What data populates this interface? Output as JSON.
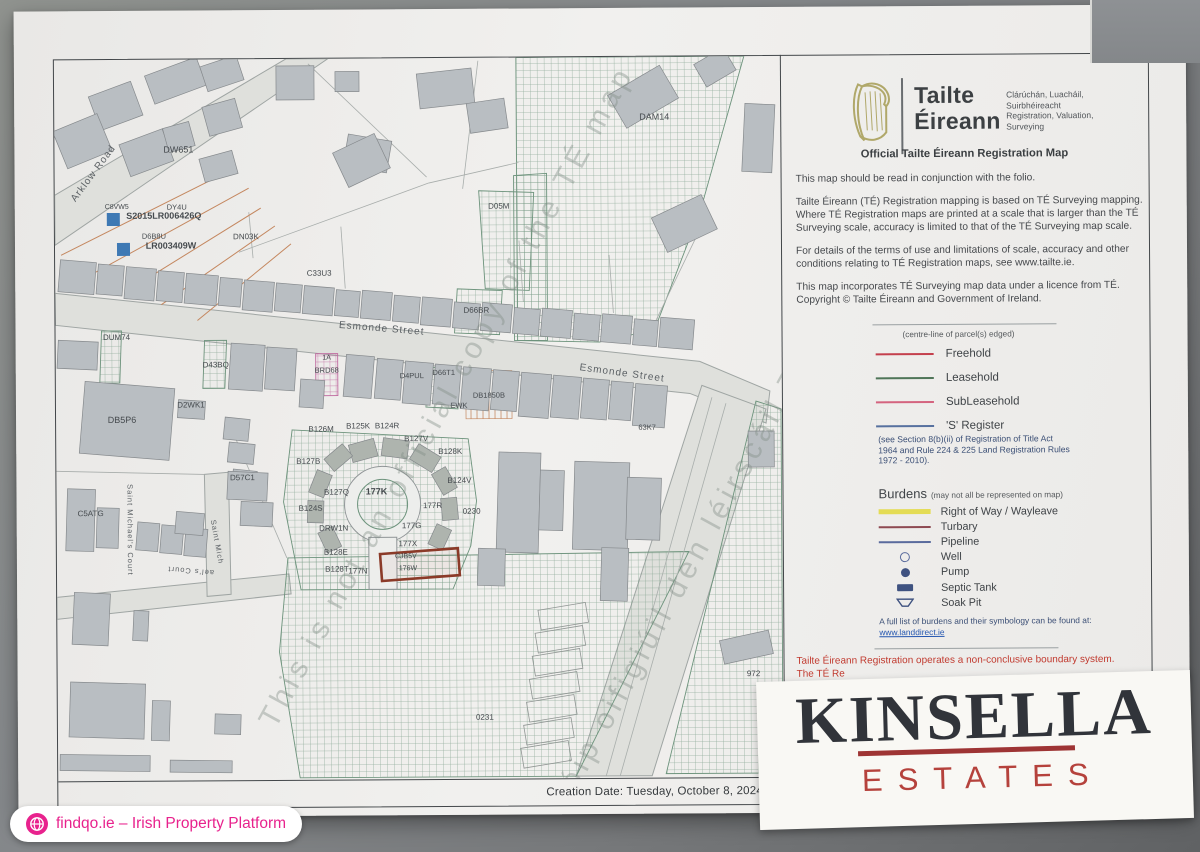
{
  "colors": {
    "accent_pink": "#e8228d",
    "kinsella_dark": "#31343a",
    "kinsella_red": "#b5423c",
    "notice_red": "#c13a2f",
    "paper": "#f1f0ee",
    "frame": "#43474a",
    "building": "#b9bec2",
    "hatch_green": "#6d937c",
    "hatch_pink": "#c06aa0",
    "blue_marker": "#3e79b4",
    "red_parcel": "#8b3a28"
  },
  "brand": {
    "name1": "Tailte",
    "name2": "Éireann",
    "sub": [
      "Clárúchán, Luacháil,",
      "Suirbhéireacht",
      "Registration, Valuation,",
      "Surveying"
    ]
  },
  "panel": {
    "heading": "Official Tailte Éireann Registration Map",
    "paragraphs": [
      "This map should be read in conjunction with the folio.",
      "Tailte Éireann (TÉ) Registration mapping is based on TÉ Surveying mapping. Where TÉ Registration maps are printed at a scale that is larger than the TÉ Surveying scale, accuracy is limited to that of the TÉ Surveying map scale.",
      "For details of the terms of use and limitations of scale, accuracy and other conditions relating to TÉ Registration maps, see www.tailte.ie.",
      "This map incorporates TÉ Surveying map data under a licence from TÉ. Copyright © Tailte Éireann and Government of Ireland."
    ],
    "legend_note_top": "(centre-line of parcel(s) edged)",
    "legend_items": [
      {
        "label": "Freehold",
        "type": "line",
        "color": "#c4404d"
      },
      {
        "label": "Leasehold",
        "type": "line",
        "color": "#4f7558"
      },
      {
        "label": "SubLeasehold",
        "type": "line",
        "color": "#d4647f"
      },
      {
        "label": "'S' Register",
        "type": "line",
        "color": "#57719f"
      }
    ],
    "legend_note_bottom": "(see Section 8(b)(ii) of Registration of Title Act 1964 and Rule 224 & 225 Land Registration Rules 1972 - 2010).",
    "burdens_title": "Burdens",
    "burdens_note": "(may not all be represented on map)",
    "burden_items": [
      {
        "label": "Right of Way / Wayleave",
        "type": "bar",
        "color": "#e4dc55"
      },
      {
        "label": "Turbary",
        "type": "line",
        "color": "#8e4a52"
      },
      {
        "label": "Pipeline",
        "type": "line",
        "color": "#5a6b9d"
      },
      {
        "label": "Well",
        "type": "circle-outline",
        "color": "#5a6b9d"
      },
      {
        "label": "Pump",
        "type": "circle-fill",
        "color": "#3f5280"
      },
      {
        "label": "Septic Tank",
        "type": "rect-fill",
        "color": "#3f5280"
      },
      {
        "label": "Soak Pit",
        "type": "trapezoid",
        "color": "#3f5280"
      }
    ],
    "burdens_footer": "A full list of burdens and their symbology can be found at: ",
    "burdens_link": "www.landdirect.ie",
    "boundary_notice": "Tailte Éireann Registration operates a non-conclusive boundary system.",
    "boundary_notice2": "The TÉ Re"
  },
  "creation_date": "Creation Date: Tuesday, October 8, 2024 3:4",
  "kinsella": {
    "line1": "KINSELLA",
    "line2": "ESTATES"
  },
  "badge": {
    "text": "findqo.ie – Irish Property Platform"
  },
  "map": {
    "roads": [
      "56,290 700,362 770,392 766,424 690,394 56,322",
      "702,386 766,410 650,776 574,776",
      "56,192 288,57 330,57 56,242",
      "56,594 288,572 290,592 56,616",
      "204,472 228,470 230,592 206,594"
    ],
    "hatches": [
      {
        "pts": "518,57 746,57 702,210 655,330 600,342 518,340 518,250",
        "p": "gh"
      },
      {
        "pts": "515,175 548,173 548,340 515,340",
        "p": "gh"
      },
      {
        "pts": "480,190 535,192 530,290 486,288",
        "p": "gh"
      },
      {
        "pts": "458,288 503,290 500,334 455,332",
        "p": "gh"
      },
      {
        "pts": "102,328 122,328 120,380 100,380",
        "p": "gh"
      },
      {
        "pts": "205,338 227,338 225,386 203,386",
        "p": "gh"
      },
      {
        "pts": "428,366 460,368 458,408 426,406",
        "p": "gh"
      },
      {
        "pts": "292,428 468,438 476,500 470,545 452,588 300,588 283,500",
        "p": "gh"
      },
      {
        "pts": "287,556 688,552 574,776 298,776 278,650",
        "p": "gh"
      },
      {
        "pts": "756,402 781,410 781,774 664,774",
        "p": "gh"
      },
      {
        "pts": "316,352 338,352 338,394 316,394",
        "p": "ph"
      }
    ],
    "tanrect": [
      466,
      370,
      46,
      48
    ],
    "gray_lines": [
      [
        240,
        250,
        430,
        182
      ],
      [
        430,
        182,
        520,
        162
      ],
      [
        310,
        62,
        428,
        176
      ],
      [
        480,
        60,
        464,
        188
      ],
      [
        700,
        232,
        652,
        330
      ],
      [
        232,
        428,
        286,
        556
      ],
      [
        56,
        468,
        204,
        472
      ],
      [
        712,
        398,
        604,
        776
      ],
      [
        726,
        404,
        618,
        776
      ],
      [
        250,
        210,
        254,
        256
      ],
      [
        342,
        225,
        346,
        287
      ],
      [
        520,
        240,
        524,
        301
      ],
      [
        610,
        255,
        614,
        313
      ]
    ],
    "tan_lines": [
      [
        62,
        252,
        232,
        168
      ],
      [
        95,
        270,
        250,
        186
      ],
      [
        128,
        288,
        262,
        206
      ],
      [
        162,
        302,
        276,
        224
      ],
      [
        198,
        318,
        292,
        242
      ]
    ],
    "ladder": [
      [
        538,
        606
      ],
      [
        535,
        629
      ],
      [
        532,
        652
      ],
      [
        529,
        675
      ],
      [
        526,
        698
      ],
      [
        523,
        721
      ],
      [
        520,
        744
      ]
    ],
    "buildings": [
      [
        60,
        258,
        36,
        32,
        5
      ],
      [
        98,
        262,
        26,
        30,
        5
      ],
      [
        126,
        265,
        30,
        32,
        5
      ],
      [
        158,
        269,
        26,
        30,
        5
      ],
      [
        186,
        272,
        32,
        30,
        5
      ],
      [
        220,
        276,
        22,
        28,
        5
      ],
      [
        244,
        279,
        30,
        30,
        5
      ],
      [
        276,
        282,
        26,
        28,
        5
      ],
      [
        304,
        285,
        30,
        28,
        5
      ],
      [
        336,
        289,
        24,
        26,
        5
      ],
      [
        362,
        290,
        30,
        28,
        5
      ],
      [
        394,
        295,
        26,
        26,
        5
      ],
      [
        422,
        297,
        30,
        28,
        5
      ],
      [
        454,
        302,
        26,
        26,
        5
      ],
      [
        482,
        303,
        30,
        28,
        5
      ],
      [
        514,
        308,
        26,
        26,
        5
      ],
      [
        542,
        309,
        30,
        28,
        5
      ],
      [
        574,
        314,
        26,
        26,
        5
      ],
      [
        602,
        315,
        30,
        28,
        5
      ],
      [
        634,
        320,
        24,
        26,
        5
      ],
      [
        660,
        319,
        34,
        30,
        5
      ],
      [
        230,
        342,
        34,
        46,
        4
      ],
      [
        266,
        346,
        30,
        42,
        4
      ],
      [
        300,
        378,
        24,
        28,
        4
      ],
      [
        345,
        354,
        28,
        42,
        5
      ],
      [
        376,
        358,
        26,
        40,
        5
      ],
      [
        404,
        361,
        28,
        42,
        5
      ],
      [
        434,
        364,
        26,
        40,
        5
      ],
      [
        462,
        367,
        28,
        42,
        5
      ],
      [
        492,
        370,
        26,
        40,
        5
      ],
      [
        520,
        373,
        30,
        44,
        5
      ],
      [
        552,
        376,
        28,
        42,
        5
      ],
      [
        582,
        379,
        26,
        40,
        5
      ],
      [
        610,
        382,
        22,
        38,
        5
      ],
      [
        634,
        385,
        32,
        42,
        5
      ],
      [
        150,
        63,
        55,
        30,
        -20
      ],
      [
        95,
        85,
        45,
        36,
        -20
      ],
      [
        205,
        58,
        38,
        26,
        -18
      ],
      [
        60,
        118,
        48,
        40,
        -22
      ],
      [
        125,
        133,
        46,
        34,
        -20
      ],
      [
        278,
        64,
        38,
        34,
        0
      ],
      [
        337,
        70,
        24,
        20,
        0
      ],
      [
        207,
        100,
        34,
        30,
        -15
      ],
      [
        167,
        122,
        27,
        25,
        -15
      ],
      [
        347,
        136,
        44,
        32,
        10
      ],
      [
        203,
        152,
        34,
        24,
        -15
      ],
      [
        420,
        70,
        55,
        35,
        -6
      ],
      [
        340,
        140,
        46,
        38,
        -25
      ],
      [
        470,
        100,
        38,
        30,
        -8
      ],
      [
        615,
        78,
        60,
        38,
        -30
      ],
      [
        700,
        55,
        34,
        26,
        -30
      ],
      [
        745,
        105,
        30,
        68,
        3
      ],
      [
        658,
        205,
        55,
        38,
        -25
      ],
      [
        82,
        382,
        90,
        72,
        5
      ],
      [
        178,
        398,
        27,
        18,
        4
      ],
      [
        58,
        338,
        40,
        28,
        3
      ],
      [
        224,
        416,
        25,
        22,
        6
      ],
      [
        228,
        441,
        26,
        20,
        6
      ],
      [
        232,
        468,
        24,
        18,
        6
      ],
      [
        227,
        470,
        40,
        28,
        3
      ],
      [
        240,
        500,
        32,
        24,
        3
      ],
      [
        66,
        486,
        28,
        62,
        2
      ],
      [
        96,
        505,
        22,
        40,
        2
      ],
      [
        136,
        520,
        22,
        28,
        5
      ],
      [
        160,
        523,
        22,
        28,
        5
      ],
      [
        184,
        526,
        22,
        28,
        5
      ],
      [
        175,
        510,
        28,
        22,
        5
      ],
      [
        72,
        590,
        36,
        52,
        3
      ],
      [
        132,
        608,
        15,
        30,
        3
      ],
      [
        68,
        680,
        75,
        55,
        2
      ],
      [
        150,
        698,
        18,
        40,
        2
      ],
      [
        213,
        712,
        26,
        20,
        2
      ],
      [
        58,
        752,
        90,
        16,
        1
      ],
      [
        168,
        758,
        62,
        12,
        1
      ],
      [
        497,
        452,
        42,
        100,
        2
      ],
      [
        539,
        470,
        24,
        60,
        2
      ],
      [
        573,
        462,
        55,
        88,
        2
      ],
      [
        626,
        478,
        34,
        62,
        2
      ],
      [
        477,
        548,
        27,
        37,
        2
      ],
      [
        600,
        548,
        27,
        53,
        2
      ],
      [
        720,
        636,
        50,
        24,
        -12
      ],
      [
        748,
        432,
        26,
        36,
        0
      ]
    ],
    "petals": [
      [
        350,
        440,
        26,
        18,
        -15
      ],
      [
        382,
        438,
        26,
        18,
        8
      ],
      [
        412,
        448,
        26,
        18,
        32
      ],
      [
        432,
        472,
        24,
        16,
        60
      ],
      [
        438,
        500,
        22,
        16,
        85
      ],
      [
        326,
        448,
        24,
        16,
        -40
      ],
      [
        308,
        474,
        24,
        16,
        -68
      ],
      [
        304,
        502,
        22,
        16,
        -88
      ],
      [
        318,
        530,
        22,
        16,
        -115
      ],
      [
        428,
        528,
        22,
        16,
        115
      ]
    ],
    "keyhole": {
      "cx": 382,
      "cy": 503,
      "r_outer": 38,
      "r_inner": 25,
      "stem": [
        368,
        536,
        28,
        52
      ]
    },
    "red_parcel": {
      "x": 380,
      "y": 550,
      "w": 78,
      "h": 27,
      "rot": -4
    },
    "blue_squares": [
      [
        108,
        210,
        13
      ],
      [
        118,
        240,
        13
      ]
    ],
    "street_labels": [
      [
        "Arklow Road",
        97,
        172,
        -53,
        10
      ],
      [
        "Esmonde Street",
        382,
        330,
        5,
        10
      ],
      [
        "Esmonde Street",
        622,
        376,
        8,
        10
      ],
      [
        "Saint Michael's Court",
        127,
        527,
        90,
        7.5
      ],
      [
        "Saint Mich",
        214,
        540,
        80,
        7.5
      ],
      [
        "ael's Court",
        190,
        566,
        185,
        7.5
      ]
    ],
    "parcel_labels": [
      [
        "DW651",
        180,
        150,
        9,
        0,
        400
      ],
      [
        "DAM14",
        656,
        120,
        9,
        0,
        400
      ],
      [
        "D05M",
        500,
        208,
        8,
        0,
        400
      ],
      [
        "DN03K",
        247,
        237,
        8,
        0,
        400
      ],
      [
        "C33U3",
        320,
        274,
        8,
        0,
        400
      ],
      [
        "C8VW5",
        118,
        206,
        7,
        0,
        400
      ],
      [
        "S2015LR006426Q",
        165,
        216,
        9,
        0,
        600
      ],
      [
        "DY4U",
        178,
        207,
        7.5,
        0,
        400
      ],
      [
        "D6B8U",
        155,
        236,
        7.5,
        0,
        400
      ],
      [
        "LR003409W",
        172,
        246,
        9,
        0,
        600
      ],
      [
        "DUM74",
        117,
        337,
        8,
        0,
        400
      ],
      [
        "D43BQ",
        216,
        365,
        8,
        0,
        400
      ],
      [
        "D66BR",
        477,
        312,
        8,
        0,
        400
      ],
      [
        "1A",
        327,
        358,
        7,
        0,
        400
      ],
      [
        "BRD68",
        327,
        371,
        7.5,
        0,
        400
      ],
      [
        "D4PUL",
        412,
        377,
        7.5,
        0,
        400
      ],
      [
        "D66T1",
        444,
        374,
        7.5,
        0,
        400
      ],
      [
        "EWK",
        459,
        407,
        7.5,
        0,
        400
      ],
      [
        "DB1850B",
        489,
        397,
        7.5,
        0,
        400
      ],
      [
        "63K7",
        647,
        430,
        7.5,
        0,
        400
      ],
      [
        "D2WK1",
        191,
        405,
        8,
        0,
        400
      ],
      [
        "DB5P6",
        122,
        420,
        9,
        0,
        400
      ],
      [
        "D57C1",
        242,
        478,
        8,
        0,
        400
      ],
      [
        "C5ATG",
        90,
        513,
        8,
        0,
        400
      ],
      [
        "B126M",
        321,
        430,
        8,
        0,
        400
      ],
      [
        "B125K",
        358,
        427,
        8,
        0,
        400
      ],
      [
        "B124R",
        387,
        427,
        8,
        0,
        400
      ],
      [
        "B127V",
        416,
        440,
        8,
        0,
        400
      ],
      [
        "B128K",
        450,
        453,
        8,
        0,
        400
      ],
      [
        "B127B",
        308,
        462,
        8,
        0,
        400
      ],
      [
        "B124V",
        459,
        482,
        8,
        0,
        400
      ],
      [
        "B127Q",
        336,
        493,
        8,
        0,
        400
      ],
      [
        "177K",
        376,
        493,
        9,
        0,
        600
      ],
      [
        "177R",
        432,
        507,
        8,
        0,
        400
      ],
      [
        "0230",
        471,
        513,
        8,
        0,
        400
      ],
      [
        "B124S",
        310,
        509,
        8,
        0,
        400
      ],
      [
        "DRW1N",
        333,
        529,
        8,
        0,
        400
      ],
      [
        "177G",
        411,
        527,
        8,
        0,
        400
      ],
      [
        "177X",
        407,
        545,
        8,
        0,
        400
      ],
      [
        "B128E",
        335,
        553,
        8,
        0,
        400
      ],
      [
        "B128T",
        336,
        570,
        8,
        0,
        400
      ],
      [
        "177N",
        357,
        572,
        8,
        0,
        400
      ],
      [
        "CJB5V",
        405,
        557,
        7,
        0,
        400
      ],
      [
        "176W",
        407,
        569,
        7,
        0,
        400
      ],
      [
        "972",
        752,
        677,
        8,
        0,
        400
      ],
      [
        "0231",
        483,
        719,
        8,
        0,
        400
      ]
    ],
    "watermarks": [
      [
        "This is not an official copy of the TÉ map",
        455,
        400,
        -61
      ],
      [
        "Ní cóip oifigiúil den léirscáil TÉ é seo",
        705,
        555,
        -61
      ]
    ]
  }
}
